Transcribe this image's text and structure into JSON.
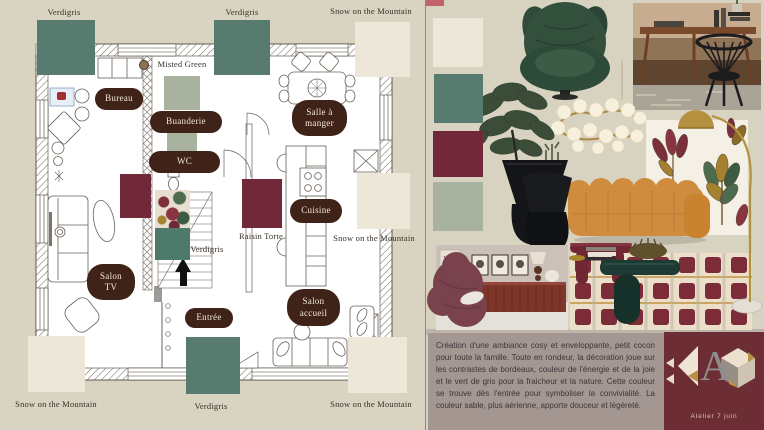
{
  "palette": {
    "verdigris": {
      "name": "Verdigris",
      "hex": "#577b6e"
    },
    "snow_on_the_mountain": {
      "name": "Snow on the Mountain",
      "hex": "#ece7d8"
    },
    "misted_green": {
      "name": "Misted Green",
      "hex": "#a9b19f"
    },
    "raisin_torte": {
      "name": "Raisin Torte",
      "hex": "#712939"
    }
  },
  "ui_colors": {
    "canvas_bg": "#d9d3c1",
    "room_pill_bg": "#3f2318",
    "description_bg": "#a49691",
    "logo_bg": "#6c2e34"
  },
  "floorplan": {
    "rooms": {
      "bureau": "Bureau",
      "buanderie": "Buanderie",
      "wc": "WC",
      "salle_a_manger_line1": "Salle à",
      "salle_a_manger_line2": "manger",
      "cuisine": "Cuisine",
      "salon_tv_line1": "Salon",
      "salon_tv_line2": "TV",
      "entree": "Entrée",
      "salon_accueil_line1": "Salon",
      "salon_accueil_line2": "accueil"
    }
  },
  "moodboard": {
    "item_names": [
      "green-velvet-egg-chair",
      "walnut-console-desk",
      "black-spindle-chair",
      "brass-bubble-chandelier",
      "potted-plant",
      "black-sculptural-vases",
      "floral-wallpaper",
      "brass-arc-floor-lamp",
      "orange-boucle-sofa",
      "burgundy-armchair-room",
      "burgundy-sideboard",
      "oxblood-console-table",
      "checkered-burgundy-rug",
      "green-lacquer-coffee-table",
      "marble-lamp-base"
    ]
  },
  "description": {
    "text": "Création d'une ambiance cosy et enveloppante, petit cocon pour toute la famille. Toute en rondeur, la décoration joue sur les contrastes de bordeaux, couleur de l'énergie et de la joie et le vert de gris pour la fraicheur et la nature. Cette couleur se trouve dès l'entrée pour symboliser la convivialité. La couleur sable, plus aérienne, apporte douceur et légèreté."
  },
  "logo": {
    "letter": "A",
    "studio": "Atelier 7 juin"
  }
}
